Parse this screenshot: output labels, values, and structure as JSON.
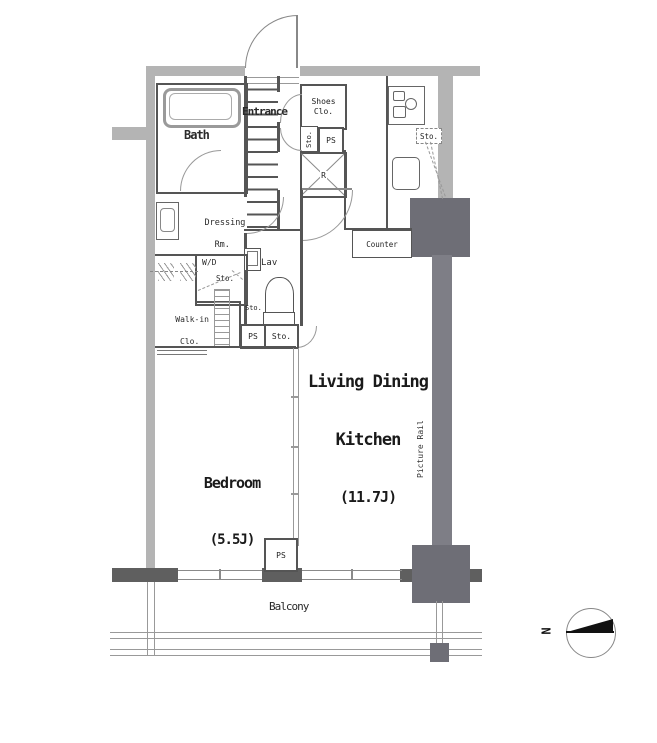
{
  "floorplan": {
    "labels": {
      "entrance": "Entrance",
      "shoes_clo_1": "Shoes",
      "shoes_clo_2": "Clo.",
      "sto_vertical": "Sto.",
      "ps_entry": "PS",
      "refrigerator": "R",
      "bath": "Bath",
      "dressing_1": "Dressing",
      "dressing_2": "Rm.",
      "washer_dryer": "W/D",
      "washer_sto": "Sto.",
      "lav": "Lav",
      "lav_sto": "Sto.",
      "walkin_1": "Walk-in",
      "walkin_2": "Clo.",
      "ps_hall": "PS",
      "sto_hall": "Sto.",
      "kitchen_sto": "Sto.",
      "counter": "Counter",
      "ldk_1": "Living Dining",
      "ldk_2": "Kitchen",
      "ldk_size": "(11.7J)",
      "picture_rail": "Picture Rail",
      "bedroom": "Bedroom",
      "bedroom_size": "(5.5J)",
      "ps_balcony": "PS",
      "balcony": "Balcony",
      "north": "N"
    },
    "colors": {
      "wall_light": "#b4b4b4",
      "wall_medium": "#7e7e86",
      "pillar_dark": "#6e6e76",
      "wall_darkest": "#5f5f5f",
      "interior_line": "#555555",
      "door_arc": "#999999",
      "background": "#ffffff"
    }
  }
}
